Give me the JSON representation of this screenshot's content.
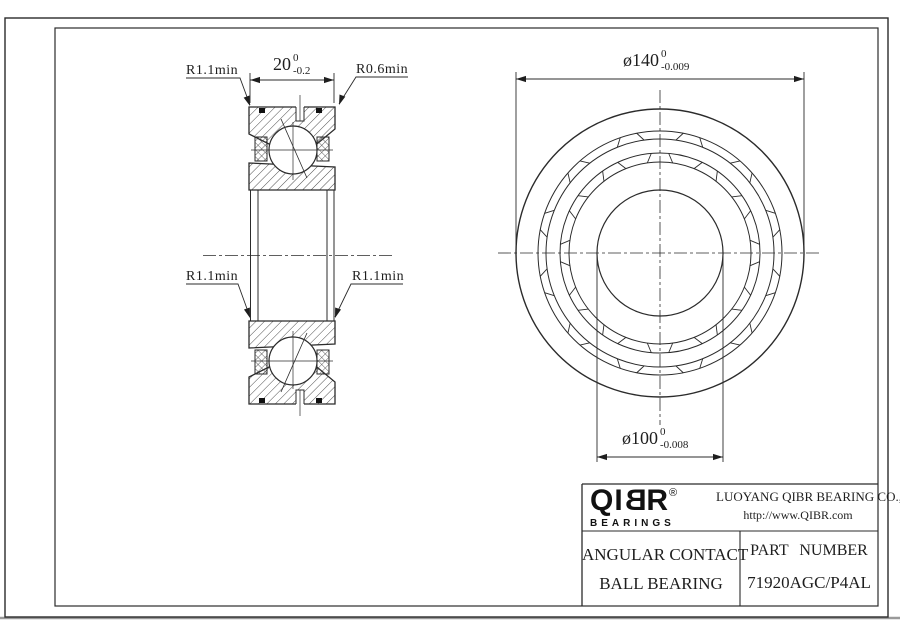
{
  "section_view": {
    "labels": {
      "r_top_left": "R1.1min",
      "r_top_right": "R0.6min",
      "r_mid_left": "R1.1min",
      "r_mid_right": "R1.1min"
    },
    "width_dim": {
      "value": "20",
      "tol_upper": "0",
      "tol_lower": "-0.2"
    }
  },
  "front_view": {
    "od_dim": {
      "value": "ø140",
      "tol_upper": "0",
      "tol_lower": "-0.009"
    },
    "bore_dim": {
      "value": "ø100",
      "tol_upper": "0",
      "tol_lower": "-0.008"
    }
  },
  "title_block": {
    "logo": {
      "prefix": "QI",
      "mirrored_letter": "B",
      "suffix": "R",
      "registered": "®",
      "tagline": "BEARINGS"
    },
    "company_name": "LUOYANG QIBR BEARING CO., LTD",
    "website": "http://www.QIBR.com",
    "product": {
      "line1": "ANGULAR CONTACT",
      "line2": "BALL BEARING"
    },
    "part_number_label": "PART NUMBER",
    "part_number": "71920AGC/P4AL"
  }
}
